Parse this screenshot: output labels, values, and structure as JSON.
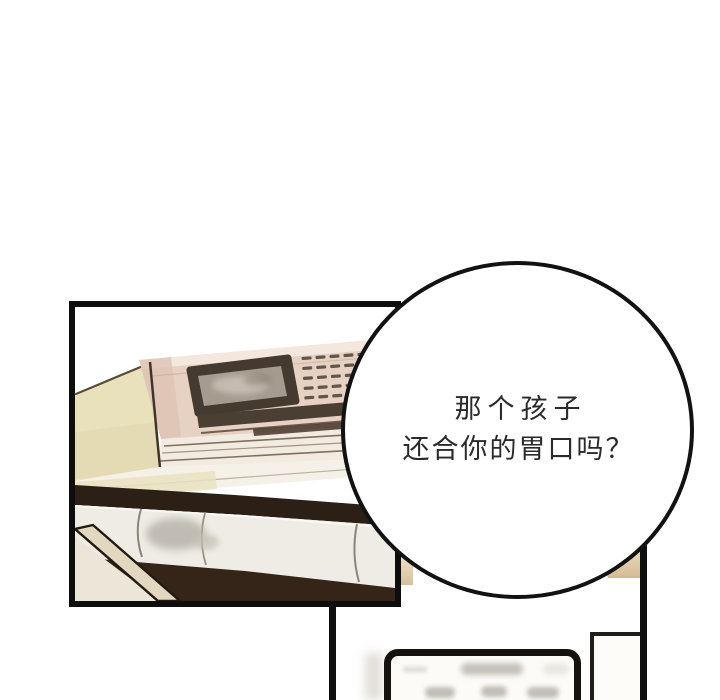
{
  "page": {
    "width_px": 720,
    "height_px": 700,
    "background_color": "#ffffff",
    "type": "webtoon-comic-page"
  },
  "speech_bubble": {
    "lines": [
      "那个孩子",
      "还合你的胃口吗？"
    ],
    "border_color": "#121212",
    "fill_color": "#ffffff",
    "text_color": "#2a2a2a"
  },
  "palette": {
    "panel_border": "#0d0d0d",
    "machine_body_pink": "#e6d1c3",
    "machine_highlight": "#f4e8de",
    "screen_frame_dark": "#453a2f",
    "screen_glass_gray": "#a59b8f",
    "book_cream": "#e9e1bc",
    "paper_light": "#f6f1e8",
    "shadow_dark_brown": "#2c1f15",
    "bottom_shadow_brown": "#342518",
    "rolled_paper": "#eeece4",
    "background_peek_beige": "#ddc7a3",
    "signboard_fill": "#fcfbf8",
    "smudge_gray": "#aaa49a"
  }
}
